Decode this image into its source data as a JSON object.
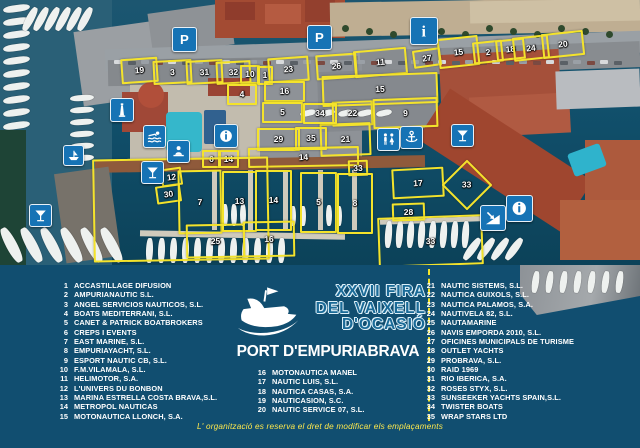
{
  "event": {
    "title_line1": "XXVII FIRA",
    "title_line2": "DEL VAIXELL",
    "title_line3": "D'OCASIÓ",
    "venue": "PORT D'EMPURIABRAVA",
    "note": "L' organització es reserva el dret de modificar els emplaçaments"
  },
  "colors": {
    "legend_bg": "#114e70",
    "marker_yellow": "#f4e32b",
    "icon_blue": "#1673b5",
    "note_yellow": "#ffe94d",
    "pool_cyan": "#35b7cb",
    "water": "#0c4259"
  },
  "legend": {
    "columns": [
      {
        "items": [
          {
            "n": "1",
            "name": "ACCASTILLAGE DIFUSION"
          },
          {
            "n": "2",
            "name": "AMPURIANAUTIC S.L."
          },
          {
            "n": "3",
            "name": "ANGEL SERVICIOS NAUTICOS, S.L."
          },
          {
            "n": "4",
            "name": "BOATS MEDITERRANI, S.L."
          },
          {
            "n": "5",
            "name": "CANET & PATRICK BOATBROKERS"
          },
          {
            "n": "6",
            "name": "CREPS I EVENTS"
          },
          {
            "n": "7",
            "name": "EAST MARINE, S.L."
          },
          {
            "n": "8",
            "name": "EMPURIAYACHT, S.L."
          },
          {
            "n": "9",
            "name": "ESPORT NAUTIC CB, S.L."
          },
          {
            "n": "10",
            "name": "F.M.VILAMALA, S.L."
          },
          {
            "n": "11",
            "name": "HELIMOTOR, S.A."
          },
          {
            "n": "12",
            "name": "L'UNIVERS DU BONBON"
          },
          {
            "n": "13",
            "name": "MARINA ESTRELLA COSTA BRAVA,S.L."
          },
          {
            "n": "14",
            "name": "METROPOL NAUTICAS"
          },
          {
            "n": "15",
            "name": "MOTONAUTICA LLONCH, S.A."
          }
        ]
      },
      {
        "items": [
          {
            "n": "16",
            "name": "MOTONAUTICA MANEL"
          },
          {
            "n": "17",
            "name": "NAUTIC LUIS, S.L."
          },
          {
            "n": "18",
            "name": "NAUTICA CASAS, S.A."
          },
          {
            "n": "19",
            "name": "NAUTICASION, S.C."
          },
          {
            "n": "20",
            "name": "NAUTIC SERVICE 07, S.L."
          }
        ]
      },
      {
        "items": [
          {
            "n": "21",
            "name": "NAUTIC SISTEMS, S.L."
          },
          {
            "n": "22",
            "name": "NAUTICA GUIXOLS, S.L."
          },
          {
            "n": "23",
            "name": "NAUTICA PALAMOS, S.A."
          },
          {
            "n": "24",
            "name": "NAUTIVELA 82, S.L."
          },
          {
            "n": "25",
            "name": "NAUTAMARINE"
          },
          {
            "n": "26",
            "name": "NAVIS EMPORDA 2010, S.L."
          },
          {
            "n": "27",
            "name": "OFICINES MUNICIPALS DE TURISME"
          },
          {
            "n": "28",
            "name": "OUTLET YACHTS"
          },
          {
            "n": "29",
            "name": "PROBRAVA, S.L."
          },
          {
            "n": "30",
            "name": "RAID 1969"
          },
          {
            "n": "31",
            "name": "RIO IBERICA, S.A."
          },
          {
            "n": "32",
            "name": "ROSES STYX, S.L."
          },
          {
            "n": "33",
            "name": "SUNSEEKER YACHTS SPAIN,S.L."
          },
          {
            "n": "34",
            "name": "TWISTER BOATS"
          },
          {
            "n": "35",
            "name": "WRAP STARS LTD"
          }
        ]
      }
    ]
  },
  "map": {
    "markers": [
      {
        "label": "19",
        "x": 121,
        "y": 58,
        "w": 33,
        "h": 21,
        "r": -4
      },
      {
        "label": "3",
        "x": 153,
        "y": 60,
        "w": 35,
        "h": 20,
        "r": -3
      },
      {
        "label": "31",
        "x": 186,
        "y": 60,
        "w": 33,
        "h": 20,
        "r": -3
      },
      {
        "label": "32",
        "x": 216,
        "y": 61,
        "w": 31,
        "h": 19,
        "r": -3
      },
      {
        "label": "10",
        "x": 240,
        "y": 65,
        "w": 16,
        "h": 15,
        "r": 0
      },
      {
        "label": "1",
        "x": 257,
        "y": 66,
        "w": 12,
        "h": 15,
        "r": 0
      },
      {
        "label": "23",
        "x": 268,
        "y": 57,
        "w": 37,
        "h": 21,
        "r": -4
      },
      {
        "label": "26",
        "x": 316,
        "y": 54,
        "w": 37,
        "h": 21,
        "r": -4
      },
      {
        "label": "11",
        "x": 354,
        "y": 49,
        "w": 49,
        "h": 23,
        "r": -5
      },
      {
        "label": "27",
        "x": 413,
        "y": 49,
        "w": 24,
        "h": 14,
        "r": -8
      },
      {
        "label": "15",
        "x": 438,
        "y": 37,
        "w": 37,
        "h": 26,
        "r": -6
      },
      {
        "label": "2",
        "x": 473,
        "y": 41,
        "w": 26,
        "h": 18,
        "r": -6
      },
      {
        "label": "18",
        "x": 496,
        "y": 39,
        "w": 25,
        "h": 17,
        "r": -6
      },
      {
        "label": "24",
        "x": 513,
        "y": 36,
        "w": 32,
        "h": 20,
        "r": -6
      },
      {
        "label": "20",
        "x": 542,
        "y": 32,
        "w": 38,
        "h": 21,
        "r": -6
      },
      {
        "label": "15",
        "x": 322,
        "y": 74,
        "w": 112,
        "h": 27,
        "r": -2
      },
      {
        "label": "22",
        "x": 332,
        "y": 101,
        "w": 37,
        "h": 21,
        "r": -2
      },
      {
        "label": "9",
        "x": 373,
        "y": 98,
        "w": 61,
        "h": 26,
        "r": -2
      },
      {
        "label": "21",
        "x": 320,
        "y": 123,
        "w": 47,
        "h": 29,
        "r": -2
      },
      {
        "label": "4",
        "x": 227,
        "y": 84,
        "w": 26,
        "h": 17,
        "r": 0
      },
      {
        "label": "16",
        "x": 264,
        "y": 81,
        "w": 37,
        "h": 17,
        "r": 0
      },
      {
        "label": "5",
        "x": 262,
        "y": 102,
        "w": 37,
        "h": 17,
        "r": 0
      },
      {
        "label": "34",
        "x": 303,
        "y": 103,
        "w": 30,
        "h": 17,
        "r": 0
      },
      {
        "label": "29",
        "x": 257,
        "y": 128,
        "w": 39,
        "h": 19,
        "r": 0
      },
      {
        "label": "35",
        "x": 295,
        "y": 127,
        "w": 28,
        "h": 19,
        "r": 0
      },
      {
        "label": "6",
        "x": 202,
        "y": 150,
        "w": 15,
        "h": 14,
        "r": 0
      },
      {
        "label": "14",
        "x": 218,
        "y": 150,
        "w": 17,
        "h": 14,
        "r": 0
      },
      {
        "label": "14",
        "x": 248,
        "y": 147,
        "w": 107,
        "h": 16,
        "r": -1
      },
      {
        "label": "33",
        "x": 348,
        "y": 160,
        "w": 16,
        "h": 12,
        "r": -2
      },
      {
        "label": "12",
        "x": 161,
        "y": 168,
        "w": 17,
        "h": 14,
        "r": -8
      },
      {
        "label": "30",
        "x": 156,
        "y": 185,
        "w": 21,
        "h": 14,
        "r": -8
      },
      {
        "label": "",
        "x": 93,
        "y": 158,
        "w": 172,
        "h": 99,
        "r": -1
      },
      {
        "label": "7",
        "x": 178,
        "y": 170,
        "w": 40,
        "h": 60,
        "r": -1
      },
      {
        "label": "13",
        "x": 222,
        "y": 171,
        "w": 31,
        "h": 57,
        "r": 0
      },
      {
        "label": "14",
        "x": 255,
        "y": 170,
        "w": 33,
        "h": 57,
        "r": 0
      },
      {
        "label": "5",
        "x": 300,
        "y": 172,
        "w": 33,
        "h": 57,
        "r": 0
      },
      {
        "label": "8",
        "x": 337,
        "y": 173,
        "w": 32,
        "h": 57,
        "r": 0
      },
      {
        "label": "25",
        "x": 186,
        "y": 224,
        "w": 55,
        "h": 30,
        "r": -1
      },
      {
        "label": "16",
        "x": 243,
        "y": 221,
        "w": 48,
        "h": 32,
        "r": -1
      },
      {
        "label": "17",
        "x": 392,
        "y": 168,
        "w": 48,
        "h": 26,
        "r": -3
      },
      {
        "label": "33",
        "x": 449,
        "y": 167,
        "w": 32,
        "h": 32,
        "r": 45
      },
      {
        "label": "28",
        "x": 392,
        "y": 203,
        "w": 29,
        "h": 14,
        "r": -2
      },
      {
        "label": "33",
        "x": 378,
        "y": 216,
        "w": 101,
        "h": 46,
        "r": -2
      }
    ],
    "icons": [
      {
        "type": "parking",
        "name": "parking-icon",
        "x": 172,
        "y": 27,
        "s": 23
      },
      {
        "type": "parking",
        "name": "parking-icon",
        "x": 307,
        "y": 25,
        "s": 23
      },
      {
        "type": "info",
        "name": "info-icon",
        "x": 410,
        "y": 17,
        "s": 26
      },
      {
        "type": "info-circle",
        "name": "info-circle-icon",
        "x": 214,
        "y": 124,
        "s": 22
      },
      {
        "type": "info-circle",
        "name": "info-circle-icon",
        "x": 506,
        "y": 195,
        "s": 25
      },
      {
        "type": "anchor",
        "name": "anchor-icon",
        "x": 400,
        "y": 126,
        "s": 21
      },
      {
        "type": "wc",
        "name": "wc-icon",
        "x": 377,
        "y": 128,
        "s": 21
      },
      {
        "type": "martini",
        "name": "cocktail-icon",
        "x": 451,
        "y": 124,
        "s": 21
      },
      {
        "type": "martini",
        "name": "cocktail-icon",
        "x": 141,
        "y": 161,
        "s": 21
      },
      {
        "type": "martini",
        "name": "cocktail-icon",
        "x": 29,
        "y": 204,
        "s": 21
      },
      {
        "type": "swimmer",
        "name": "swimmer-icon",
        "x": 143,
        "y": 125,
        "s": 21
      },
      {
        "type": "desk",
        "name": "reception-icon",
        "x": 167,
        "y": 140,
        "s": 21
      },
      {
        "type": "lighthouse",
        "name": "lighthouse-icon",
        "x": 110,
        "y": 98,
        "s": 22
      },
      {
        "type": "slipway",
        "name": "slipway-icon",
        "x": 480,
        "y": 205,
        "s": 24
      },
      {
        "type": "boat",
        "name": "boat-lift-icon",
        "x": 63,
        "y": 145,
        "s": 19
      }
    ]
  }
}
